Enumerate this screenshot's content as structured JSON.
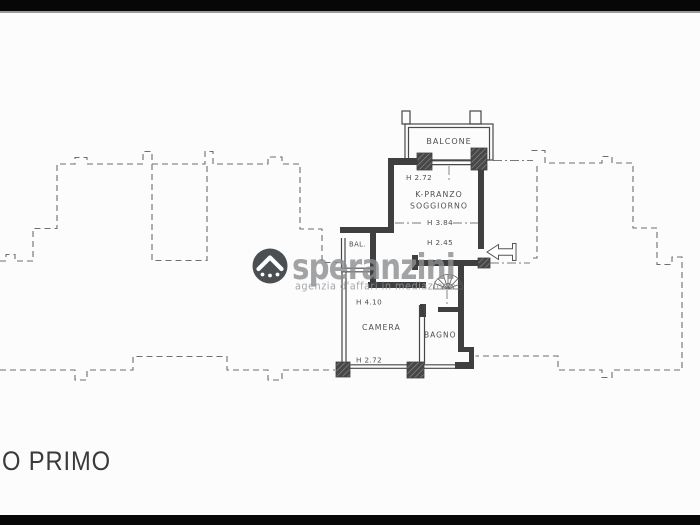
{
  "page": {
    "floor_title": "O PRIMO"
  },
  "watermark": {
    "brand": "speranzini",
    "tagline": "agenzia d'affari in mediazione"
  },
  "plan": {
    "rooms": {
      "balcone": {
        "label": "BALCONE"
      },
      "soggiorno": {
        "label_line1": "K-PRANZO",
        "label_line2": "SOGGIORNO",
        "height_top": "H 2.72",
        "height_mid": "H 3.84",
        "height_low": "H 2.45"
      },
      "bal": {
        "label": "BAL."
      },
      "camera": {
        "label": "CAMERA",
        "height_top": "H 4.10",
        "height_bottom": "H 2.72"
      },
      "bagno": {
        "label": "BAGNO"
      }
    },
    "colors": {
      "wall": "#3f3f3f",
      "dashed_line": "#6e6e6e",
      "label": "#4f4f4f",
      "background": "#fcfcfc",
      "letterbox": "#070707",
      "watermark_gray": "#8b8d90",
      "logo_dark": "#3c4043"
    }
  }
}
